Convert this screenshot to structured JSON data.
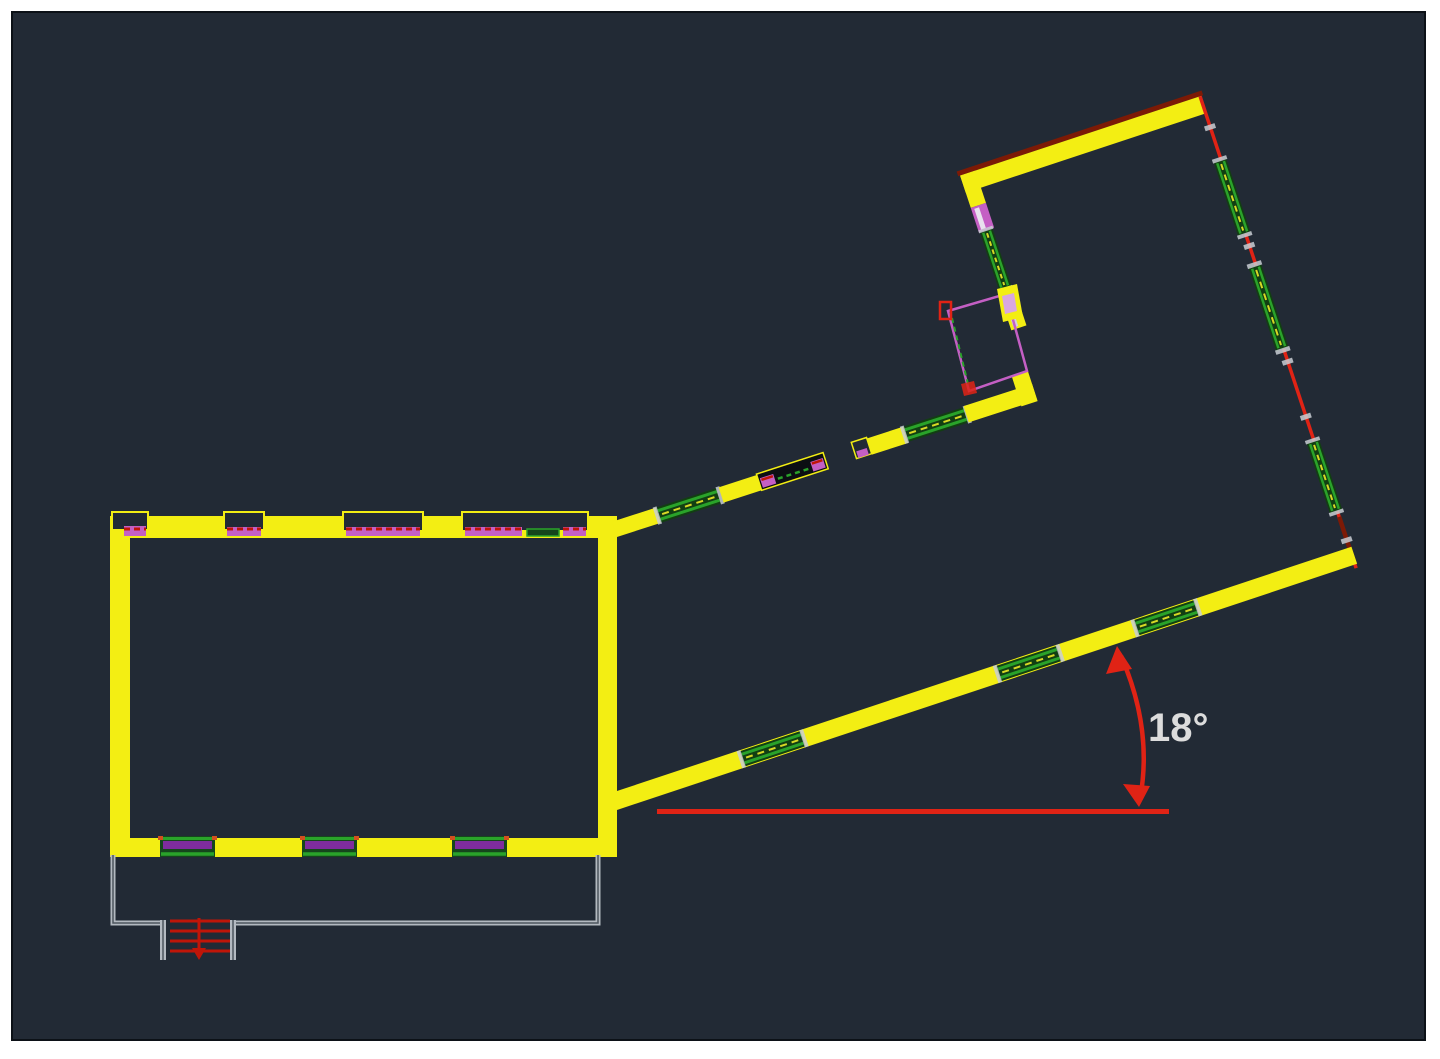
{
  "canvas": {
    "page_background": "#ffffff",
    "background": "#222a35",
    "border_color": "#0c1117"
  },
  "annotation": {
    "angle_label": "18°",
    "angle_value_degrees": 18
  },
  "colors": {
    "wall_yellow": "#f3ee13",
    "roof_dark_red": "#7c1a06",
    "line_red": "#e02315",
    "stair_red": "#c01508",
    "window_green": "#2aa32a",
    "window_fill_dark": "#123f12",
    "window_fill_green": "#15461c",
    "mullion_purple": "#7e2c9e",
    "door_magenta": "#c45fc4",
    "door_magenta_light": "#d9a7e0",
    "deck_gray": "#b3b9c0",
    "deck_gray_dark": "#4d555e",
    "tick_white": "#c9ced4",
    "label_text": "#dcdcdc",
    "accent_orange": "#d2501e",
    "glass_yellow": "#d8d825"
  }
}
